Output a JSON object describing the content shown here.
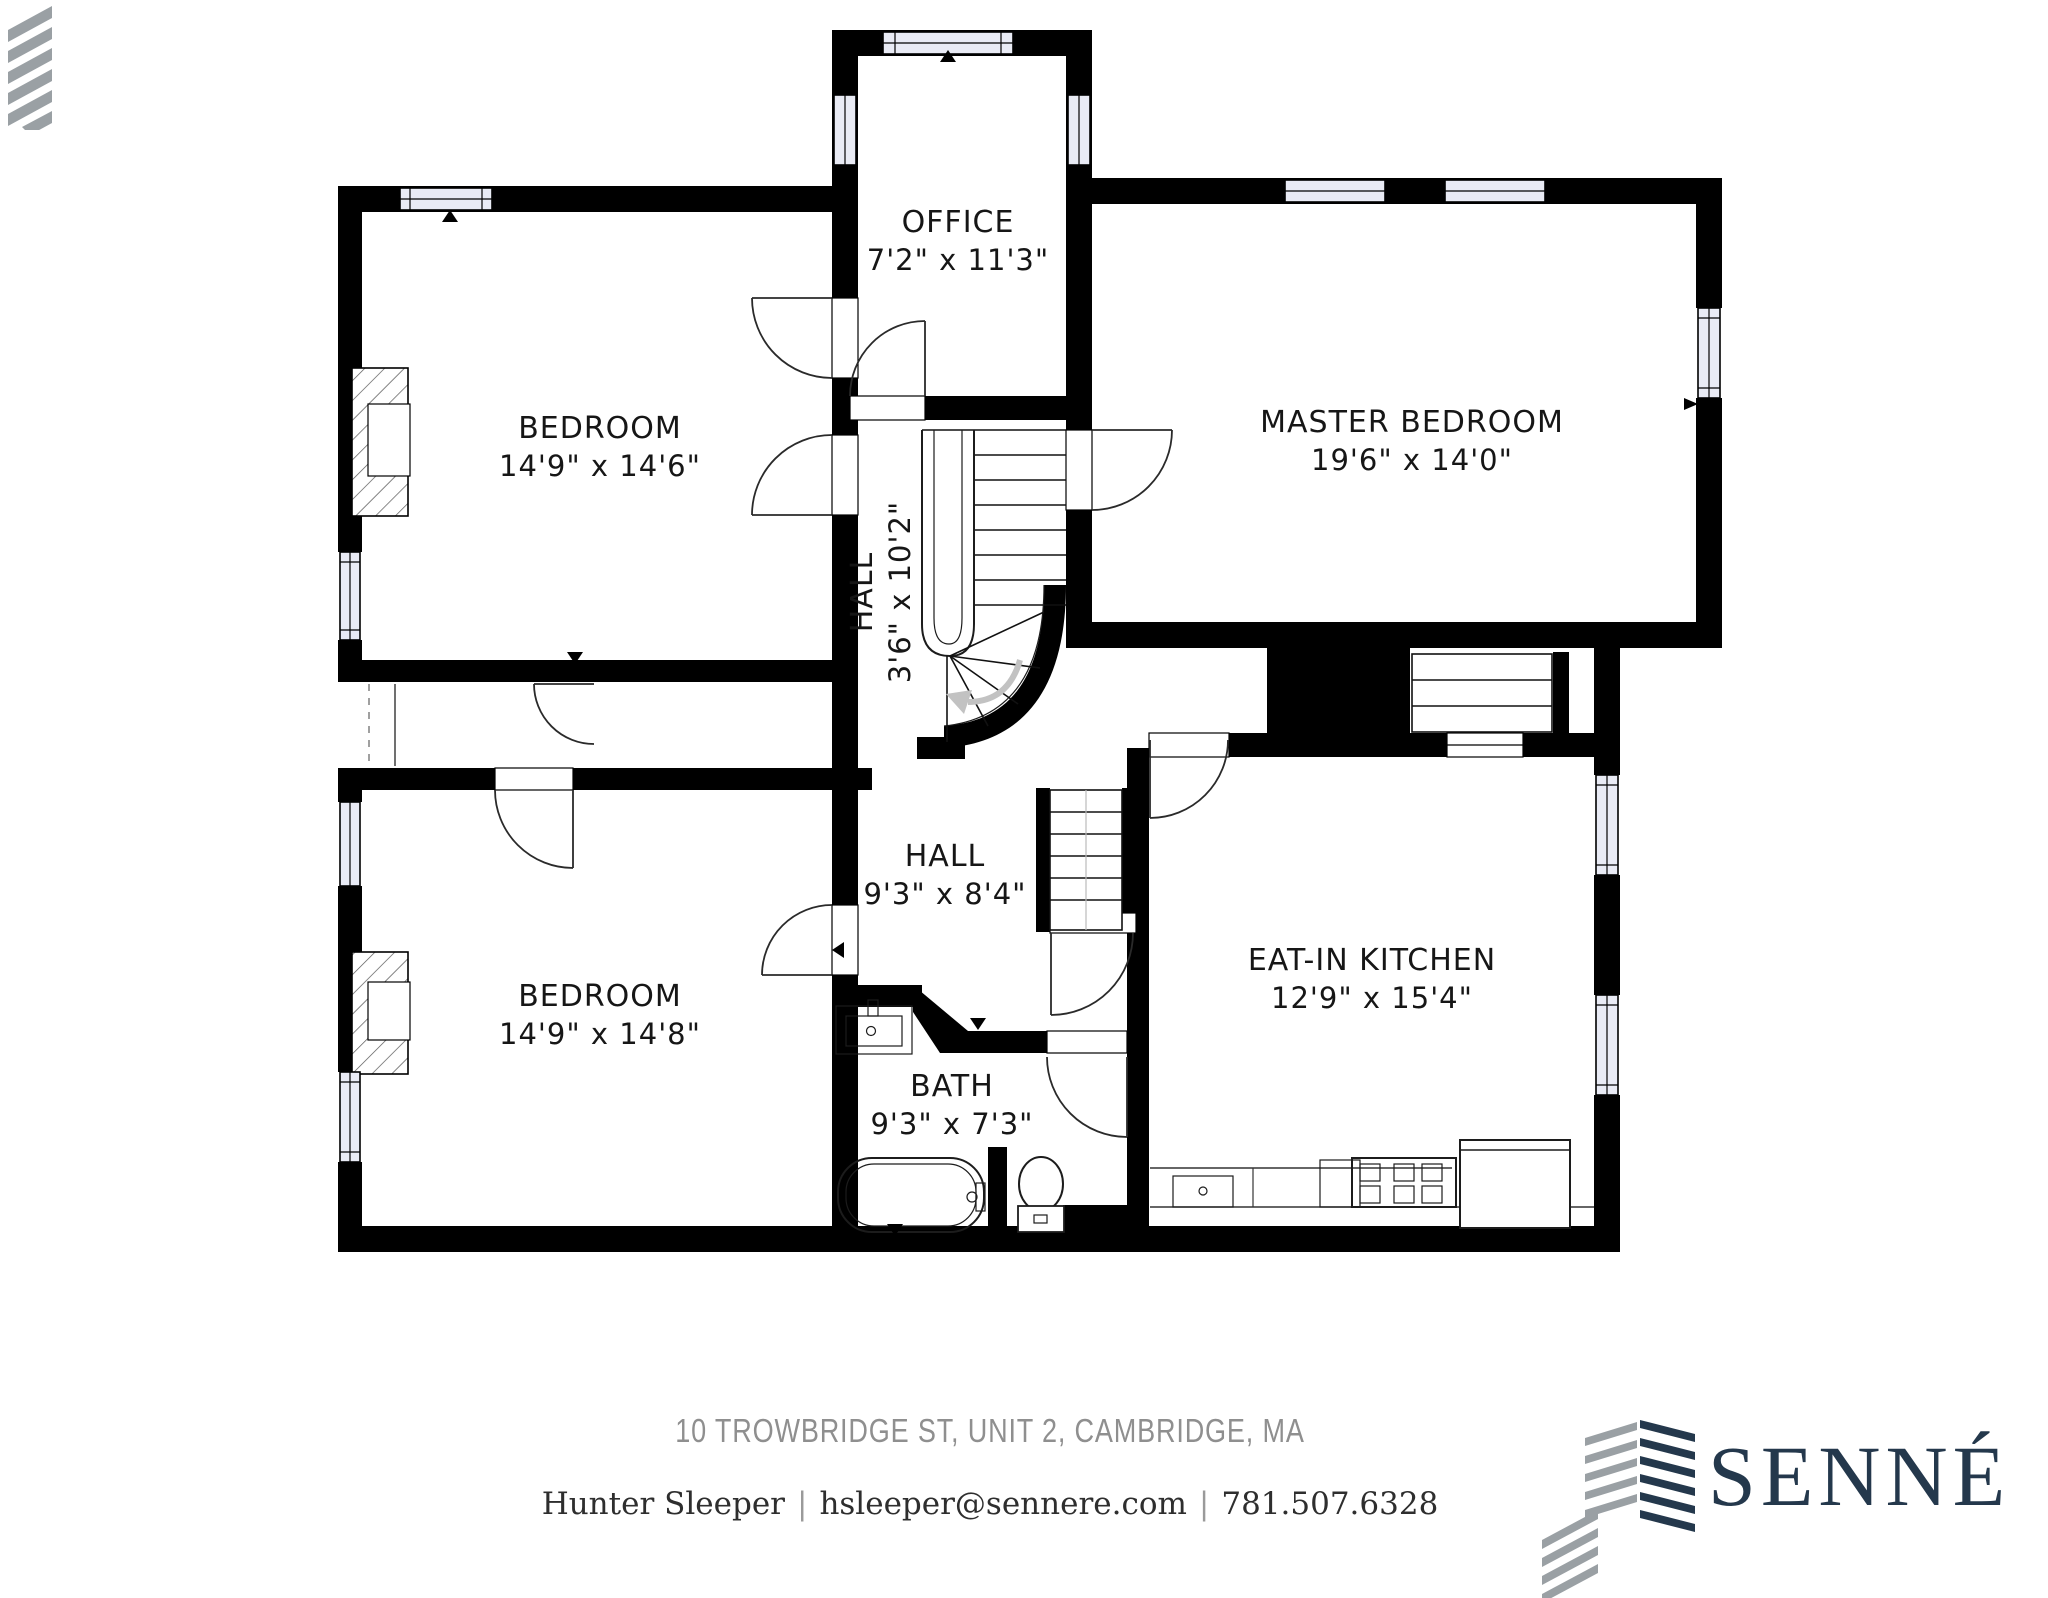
{
  "plan": {
    "rooms": [
      {
        "id": "office",
        "name": "OFFICE",
        "dims": "7'2\" x 11'3\""
      },
      {
        "id": "bedroom-top",
        "name": "BEDROOM",
        "dims": "14'9\" x 14'6\""
      },
      {
        "id": "master-bedroom",
        "name": "MASTER BEDROOM",
        "dims": "19'6\" x 14'0\""
      },
      {
        "id": "hall-stairs",
        "name": "HALL",
        "dims": "3'6\" x 10'2\""
      },
      {
        "id": "hall",
        "name": "HALL",
        "dims": "9'3\" x 8'4\""
      },
      {
        "id": "bedroom-bottom",
        "name": "BEDROOM",
        "dims": "14'9\" x 14'8\""
      },
      {
        "id": "eat-in-kitchen",
        "name": "EAT-IN KITCHEN",
        "dims": "12'9\" x 15'4\""
      },
      {
        "id": "bath",
        "name": "BATH",
        "dims": "9'3\" x 7'3\""
      }
    ]
  },
  "footer": {
    "address": "10 TROWBRIDGE ST, UNIT 2, CAMBRIDGE, MA",
    "agent": {
      "name": "Hunter Sleeper",
      "email": "hsleeper@sennere.com",
      "phone": "781.507.6328"
    },
    "separator": "|"
  },
  "brand": {
    "logo_text": "SENNÉ",
    "navy": "#24384c",
    "gray": "#9aa0a4"
  }
}
